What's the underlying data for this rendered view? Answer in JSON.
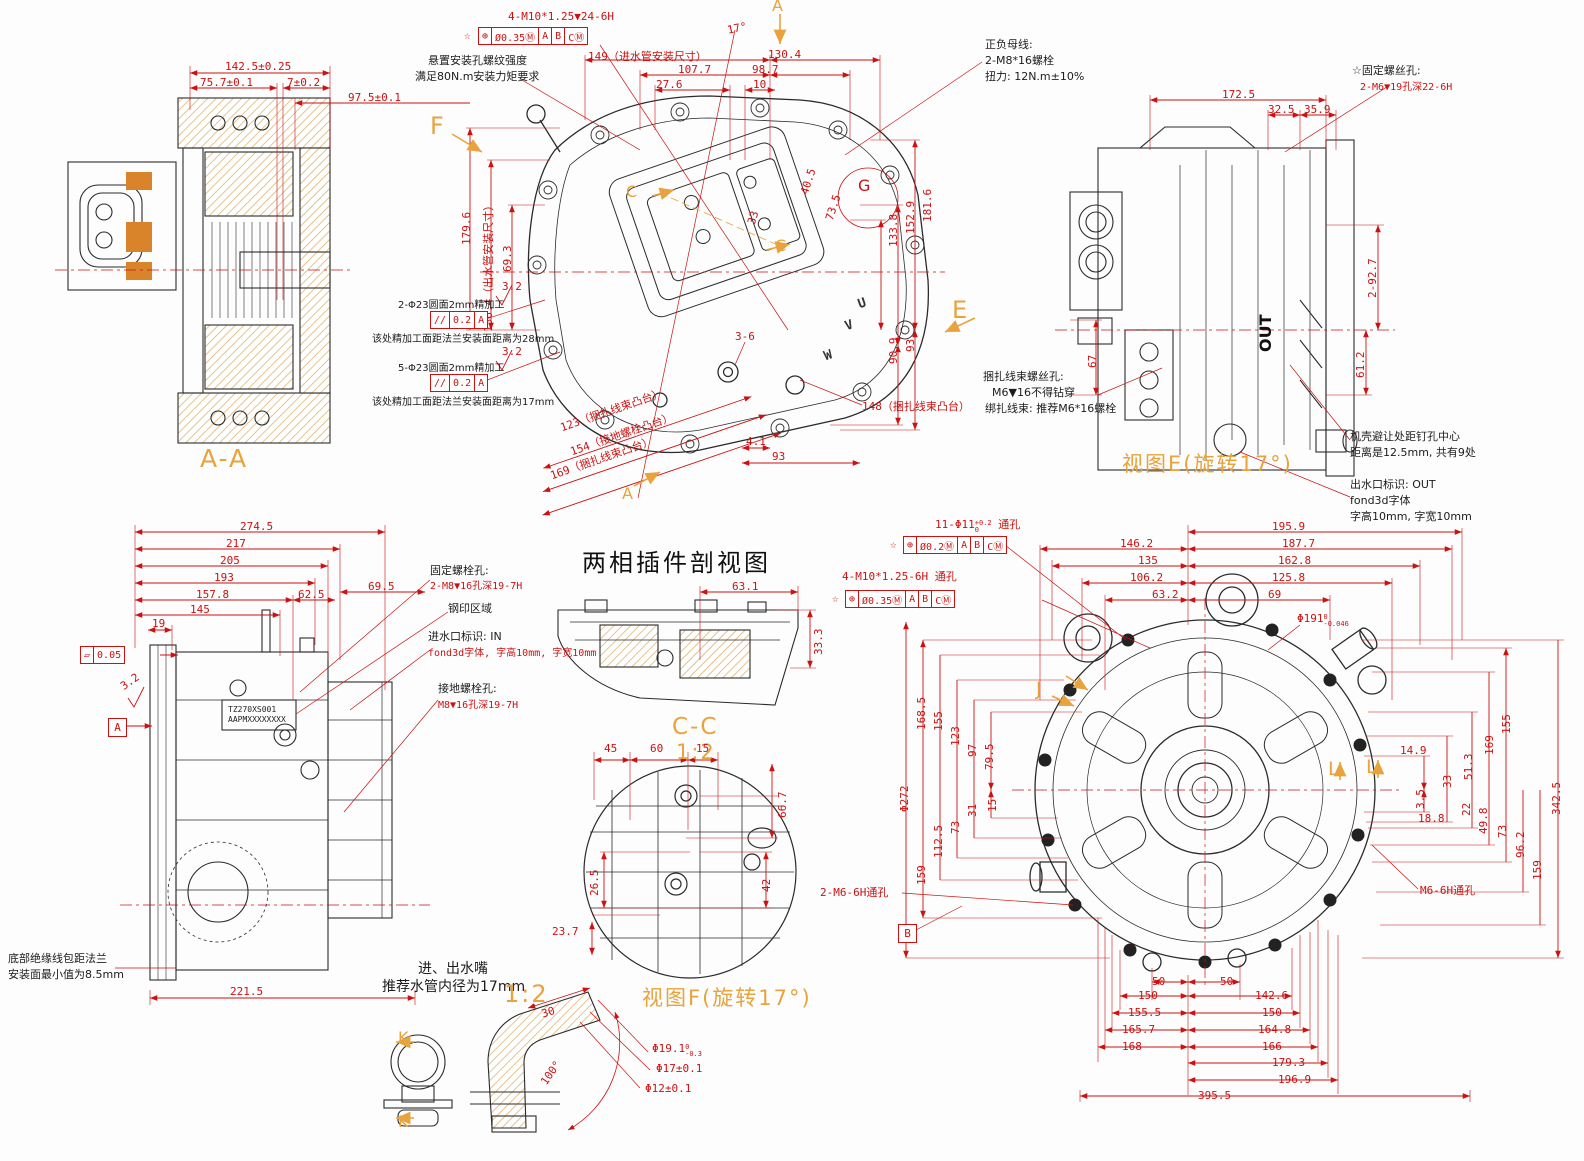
{
  "colors": {
    "dim": "#cc1111",
    "note": "#1c1c1c",
    "view_label": "#e8a33d",
    "hatch": "#dcb06a",
    "copper": "#d9832b"
  },
  "aa": {
    "label": "A-A",
    "dims": {
      "total": "142.5±0.25",
      "left": "75.7±0.1",
      "right": "7±0.2",
      "depth": "97.5±0.1"
    }
  },
  "mv": {
    "labels": {
      "f": "F",
      "a_top": "A",
      "a_bottom": "A",
      "c1": "C",
      "c2": "C",
      "e": "E",
      "g": "G",
      "u": "U",
      "v": "V",
      "w": "W"
    },
    "dims": {
      "thread": "4-M10*1.25▼24-6H",
      "gdt": {
        "star": "☆",
        "sym": "⊕",
        "tol": "Ø0.35Ⓜ",
        "d1": "A",
        "d2": "B",
        "d3": "CⓂ"
      },
      "angle": "17°",
      "water_in": "149（进水管安装尺寸）",
      "d130_4": "130.4",
      "d107_7": "107.7",
      "d98_7": "98.7",
      "d27_6": "27.6",
      "d10": "10",
      "d179_6": "179.6",
      "water_out": "136.4（出水管安装尺寸）",
      "d69_3": "69.3",
      "d181_6": "181.6",
      "d152_9": "152.9",
      "d133_8": "133.8",
      "d90_9": "90.9",
      "d93_right": "93",
      "d40_5": "40.5",
      "d73_5": "73.5",
      "d33": "33",
      "boss123": "123（捆扎线束凸台）",
      "boss154": "154（接地螺栓凸台）",
      "boss169": "169（捆扎线束凸台）",
      "boss148": "148（捆扎线束凸台）",
      "d3_6": "3-6",
      "d4_1": "4.1",
      "d93_bottom": "93",
      "rough1": "3.2",
      "rough2": "3.2",
      "par": {
        "sym": "//",
        "tol": "0.2",
        "datum": "A"
      }
    },
    "notes": {
      "suspension1": "悬置安装孔螺纹强度",
      "suspension2": "满足80N.m安装力矩要求",
      "busbar1": "正负母线:",
      "busbar2": "2-M8*16螺栓",
      "busbar3": "扭力: 12N.m±10%",
      "mach1a": "2-Φ23圆面2mm精加工",
      "mach1b": "该处精加工面距法兰安装面距离为28mm",
      "mach2a": "5-Φ23圆面2mm精加工",
      "mach2b": "该处精加工面距法兰安装面距离为17mm"
    }
  },
  "ve": {
    "label": "视图E(旋转17°)",
    "dims": {
      "d172_5": "172.5",
      "d32_5": "32.5",
      "d35_9": "35.9",
      "d2_92_7": "2-92.7",
      "d61_2": "61.2",
      "d67": "67"
    },
    "notes": {
      "fix1": "☆固定螺丝孔:",
      "fix2": "2-M6▼19孔深22-6H",
      "bundle1": "捆扎线束螺丝孔:",
      "bundle2": "M6▼16不得钻穿",
      "bundle3": "绑扎线束: 推荐M6*16螺栓",
      "avoid1": "机壳避让处距钉孔中心",
      "avoid2": "距离是12.5mm, 共有9处",
      "out1": "出水口标识: OUT",
      "out2": "fond3d字体",
      "out3": "字高10mm, 字宽10mm",
      "out_mark": "OUT"
    }
  },
  "sv": {
    "dims": {
      "d274_5": "274.5",
      "d217": "217",
      "d205": "205",
      "d193": "193",
      "d157_8": "157.8",
      "d145": "145",
      "d62_5": "62.5",
      "d69_5": "69.5",
      "d19": "19",
      "d221_5": "221.5",
      "rough": "3.2",
      "flat_sym": "▱",
      "flat_tol": "0.05",
      "datum": "A"
    },
    "plate1": "TZ270XS001",
    "plate2": "AAPMXXXXXXXX",
    "notes": {
      "fix1": "固定螺栓孔:",
      "fix2": "2-M8▼16孔深19-7H",
      "stamp": "钢印区域",
      "in1": "进水口标识: IN",
      "in2": "fond3d字体, 字高10mm, 字宽10mm",
      "ground1": "接地螺栓孔:",
      "ground2": "M8▼16孔深19-7H",
      "bottom1": "底部绝缘线包距法兰",
      "bottom2": "安装面最小值为8.5mm"
    }
  },
  "cc": {
    "title": "两相插件剖视图",
    "label": "C-C",
    "scale": "1:2",
    "dims": {
      "d63_1": "63.1",
      "d33_3": "33.3"
    }
  },
  "vf": {
    "label": "视图F(旋转17°)",
    "dims": {
      "d45": "45",
      "d60": "60",
      "d15": "15",
      "d66_7": "66.7",
      "d42": "42",
      "d26_5": "26.5",
      "d23_7": "23.7"
    }
  },
  "nz": {
    "notes": {
      "n1": "进、出水嘴",
      "n2": "推荐水管内径为17mm"
    },
    "scale": "1:2",
    "k1": "K",
    "k2": "K",
    "dims": {
      "d30": "30",
      "d19_1": "Φ19.1",
      "d19_1_up": "0",
      "d19_1_lo": "-0.3",
      "d17": "Φ17±0.1",
      "d12": "Φ12±0.1",
      "angle": "100°"
    }
  },
  "rv": {
    "notes": {
      "holes11": "11-Φ11",
      "holes11_up": "+0.2",
      "holes11_lo": "0",
      "holes11_suffix": "通孔",
      "gdt2": {
        "star": "☆",
        "sym": "⊕",
        "tol": "Ø0.2Ⓜ",
        "d1": "A",
        "d2": "B",
        "d3": "CⓂ"
      },
      "holes4": "4-M10*1.25-6H 通孔",
      "gdt3": {
        "star": "☆",
        "sym": "⊕",
        "tol": "Ø0.35Ⓜ",
        "d1": "A",
        "d2": "B",
        "d3": "CⓂ"
      },
      "m6": "M6-6H通孔",
      "m6x2": "2-M6-6H通孔"
    },
    "labels": {
      "j": "J",
      "l1": "L",
      "l2": "L",
      "datum_b": "B"
    },
    "dims": {
      "d195_9": "195.9",
      "d187_7": "187.7",
      "d146_2": "146.2",
      "d162_8": "162.8",
      "d135": "135",
      "d106_2": "106.2",
      "d125_8": "125.8",
      "d63_2": "63.2",
      "d69": "69",
      "d191": "Φ191",
      "d191_up": "0",
      "d191_lo": "-0.046",
      "d272": "Φ272",
      "d168_5": "168.5",
      "d155_l": "155",
      "d123": "123",
      "d97": "97",
      "d79_5": "79.5",
      "d15": "15",
      "d31": "31",
      "d73_l": "73",
      "d112_5": "112.5",
      "d159_l": "159",
      "d155_r": "155",
      "d169": "169",
      "d14_9": "14.9",
      "d51_3": "51.3",
      "d33": "33",
      "d3_5": "3.5",
      "d22": "22",
      "d49_8": "49.8",
      "d18_8": "18.8",
      "d73_r": "73",
      "d96_2": "96.2",
      "d159_r": "159",
      "d342_5": "342.5",
      "d50a": "50",
      "d50b": "50",
      "d150a": "150",
      "d142_6": "142.6",
      "d155_5": "155.5",
      "d150b": "150",
      "d165_7": "165.7",
      "d164_8": "164.8",
      "d168": "168",
      "d166": "166",
      "d179_3": "179.3",
      "d196_9": "196.9",
      "d395_5": "395.5"
    }
  }
}
